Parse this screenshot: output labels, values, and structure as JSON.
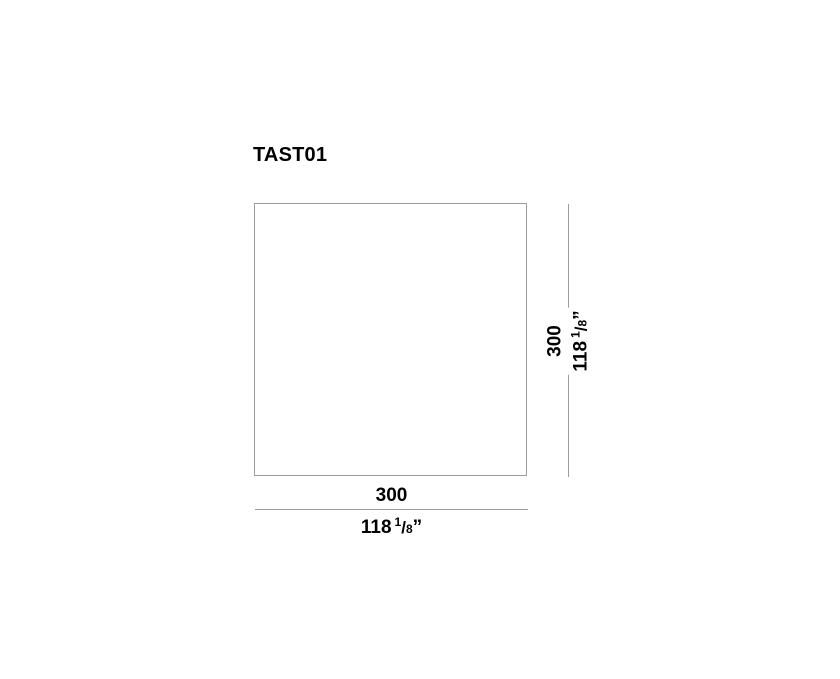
{
  "drawing": {
    "title": "TAST01",
    "shape": "square-plan-outline",
    "colors": {
      "line": "#9c9c9c",
      "text": "#000000",
      "background": "#ffffff"
    },
    "height_dimension": {
      "mm": "300",
      "in_whole": "118",
      "in_frac_num": "1",
      "in_frac_slash": "/",
      "in_frac_den": "8",
      "in_unit": "”"
    },
    "width_dimension": {
      "mm": "300",
      "in_whole": "118",
      "in_frac_num": "1",
      "in_frac_slash": "/",
      "in_frac_den": "8",
      "in_unit": "”"
    }
  }
}
